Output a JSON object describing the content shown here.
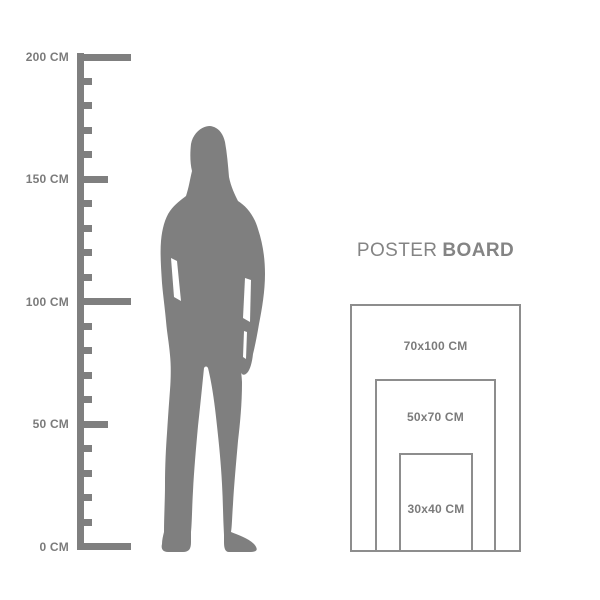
{
  "ruler": {
    "unit": "CM",
    "top_cm": 200,
    "bottom_cm": 0,
    "step_cm": 10,
    "major_cm": [
      200,
      100,
      0
    ],
    "medium_cm": [
      150,
      50
    ],
    "labels": [
      {
        "cm": 200,
        "text": "200 CM"
      },
      {
        "cm": 150,
        "text": "150 CM"
      },
      {
        "cm": 100,
        "text": "100 CM"
      },
      {
        "cm": 50,
        "text": "50 CM"
      },
      {
        "cm": 0,
        "text": "0 CM"
      }
    ]
  },
  "figure": {
    "icon": "woman-silhouette"
  },
  "poster": {
    "title": {
      "regular": "POSTER",
      "bold": "BOARD"
    },
    "sizes": [
      {
        "label": "70x100 CM"
      },
      {
        "label": "50x70 CM"
      },
      {
        "label": "30x40 CM"
      }
    ]
  },
  "colors": {
    "shape": "#7f7f7f",
    "text": "#7b7b7b",
    "border": "#8d8d8d",
    "title": "#848484"
  }
}
